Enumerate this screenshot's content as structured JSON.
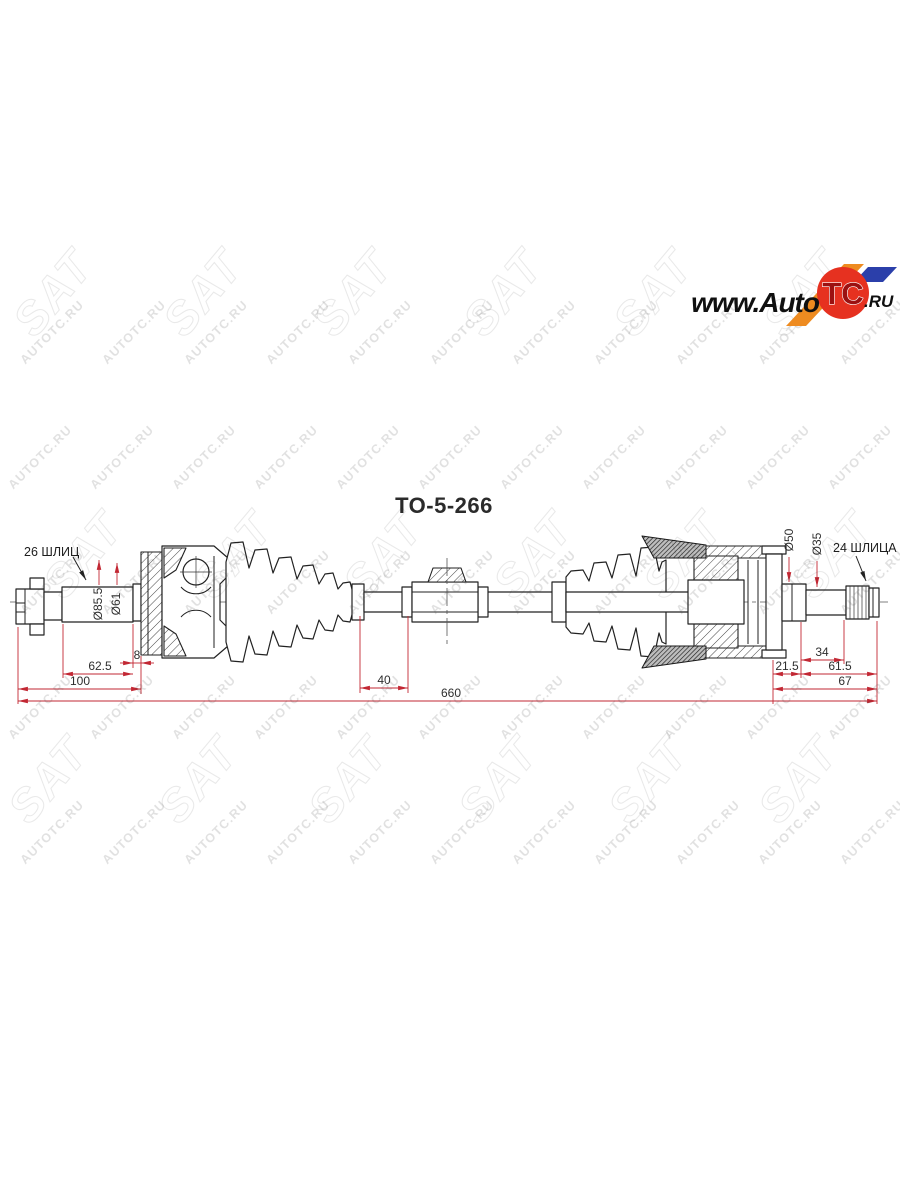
{
  "part_number": "TO-5-266",
  "watermark": {
    "text": "AUTOTC.RU",
    "logo_text": "SAT",
    "color": "#d9d9d9",
    "text_rows": [
      {
        "y": 335,
        "x0": 55,
        "dx": 82,
        "n": 11
      },
      {
        "y": 460,
        "x0": 43,
        "dx": 82,
        "n": 11
      },
      {
        "y": 585,
        "x0": 55,
        "dx": 82,
        "n": 11
      },
      {
        "y": 710,
        "x0": 43,
        "dx": 82,
        "n": 11
      },
      {
        "y": 835,
        "x0": 55,
        "dx": 82,
        "n": 11
      }
    ],
    "sat_rows": [
      {
        "y": 303,
        "x0": 65,
        "dx": 150,
        "n": 6
      },
      {
        "y": 565,
        "x0": 95,
        "dx": 150,
        "n": 6
      },
      {
        "y": 790,
        "x0": 60,
        "dx": 150,
        "n": 6
      }
    ]
  },
  "logo": {
    "www_auto": "www.Auto",
    "tc": "TC",
    "ru": ".RU",
    "circle_color": "#e63120",
    "orange_color": "#ee8b20",
    "blue_color": "#2b3faa"
  },
  "drawing": {
    "labels": {
      "left_spline": "26 ШЛИЦ",
      "right_spline": "24 ШЛИЦА"
    },
    "dimensions": {
      "dia85_5": "Ø85.5",
      "dia61": "Ø61",
      "dia50": "Ø50",
      "dia35": "Ø35",
      "len8": "8",
      "len62_5": "62.5",
      "len100": "100",
      "len40": "40",
      "len660": "660",
      "len21_5": "21.5",
      "len34": "34",
      "len61_5": "61.5",
      "len67": "67"
    },
    "dim_color": "#c22733",
    "line_color": "#222222"
  }
}
